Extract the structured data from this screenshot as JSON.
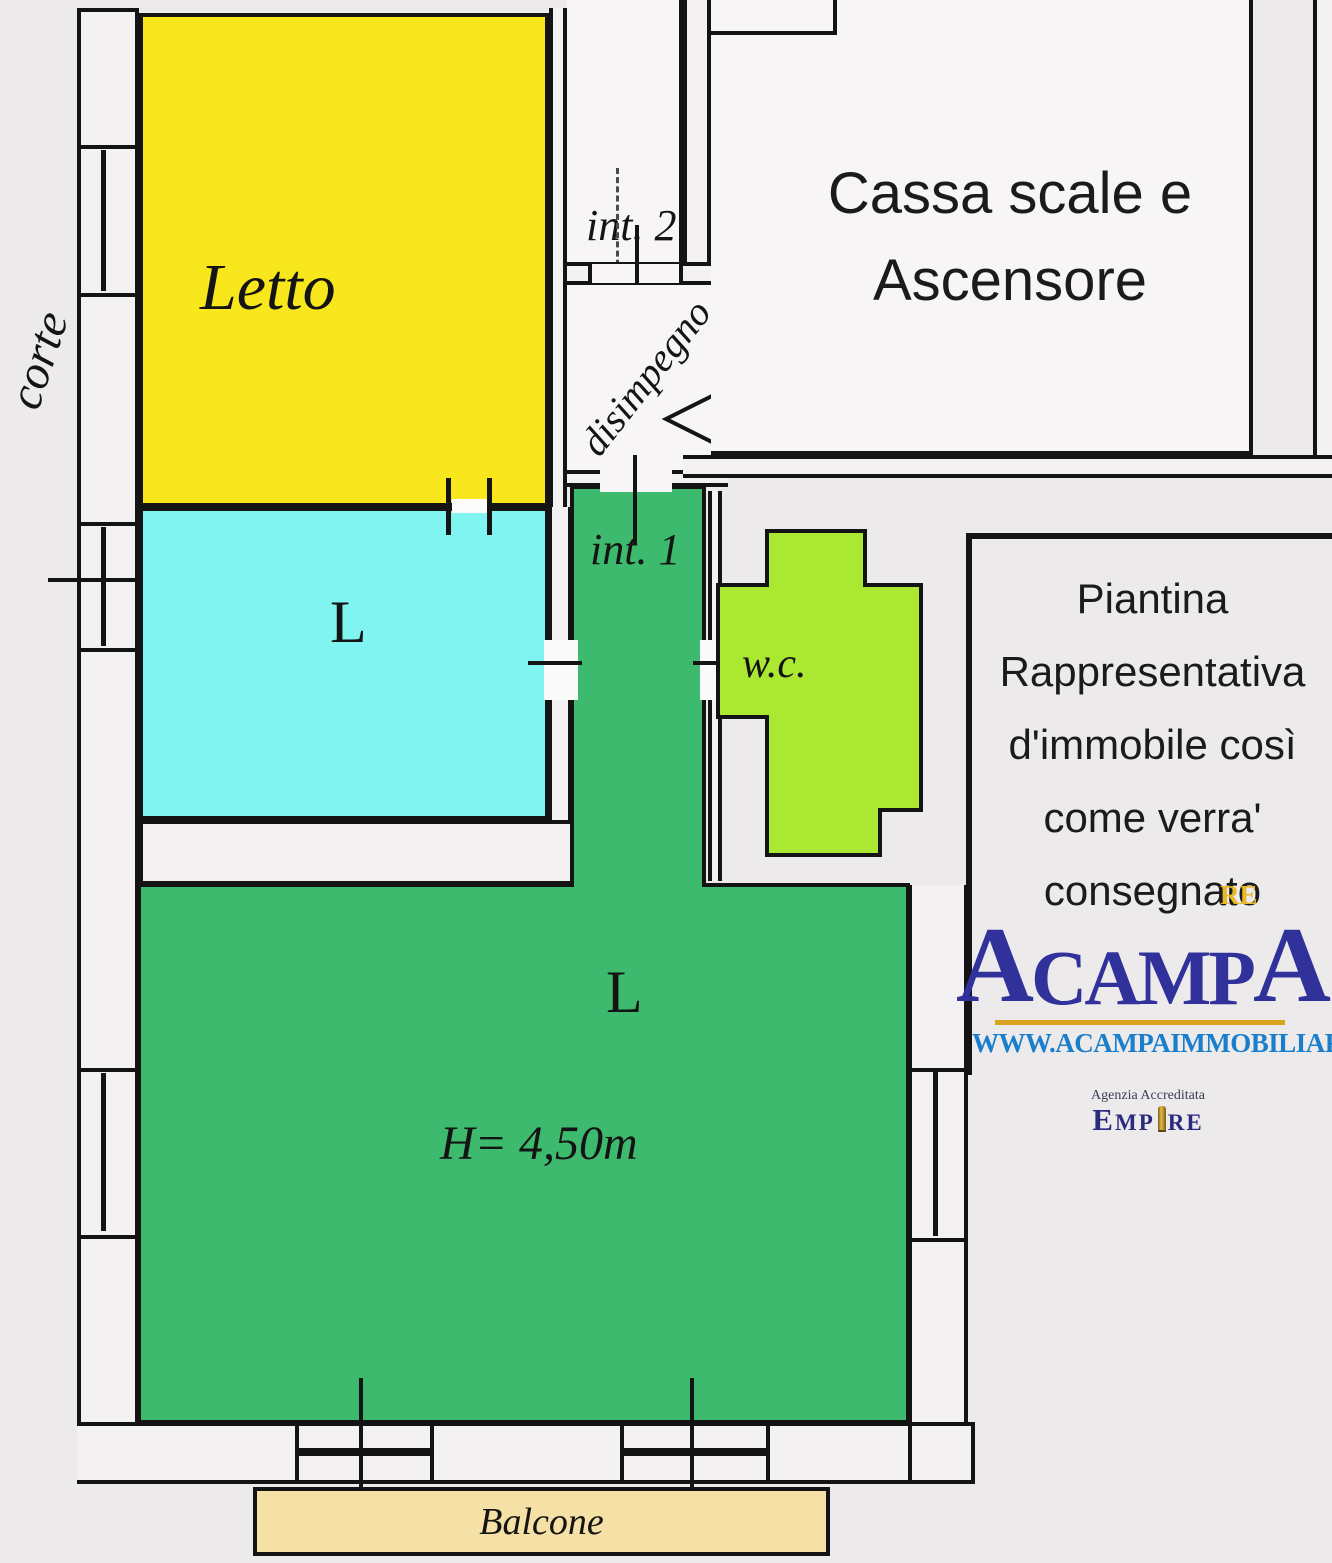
{
  "plan_title": "floor-plan",
  "rooms": {
    "letto": {
      "label": "Letto",
      "color": "#f8e71c"
    },
    "living_small": {
      "label": "L",
      "color": "#80f4f0"
    },
    "corridor": {
      "label": "int. 1",
      "color": "#3eba6e"
    },
    "living_large": {
      "label": "L",
      "height_note": "H= 4,50m",
      "color": "#3eba6e"
    },
    "wc": {
      "label": "w.c.",
      "color": "#abe832"
    },
    "stairwell": {
      "line1": "Cassa scale e",
      "line2": "Ascensore"
    },
    "int2": {
      "label": "int. 2"
    },
    "disimpegno": {
      "label": "disimpegno"
    },
    "balcone": {
      "label": "Balcone",
      "color": "#f5e0a5"
    },
    "corte": {
      "label": "corte"
    }
  },
  "annotation": {
    "lines": [
      "Piantina",
      "Rappresentativa",
      "d'immobile così",
      "come verra'",
      "consegnato"
    ]
  },
  "logo": {
    "brand_first": "A",
    "brand_middle": "CAMP",
    "brand_last": "A",
    "re_tag": "RE",
    "website": "WWW.ACAMPAIMMOBILIARE.IT",
    "accreditation": "Agenzia Accreditata",
    "empire_e": "E",
    "empire_mp": "MP",
    "empire_re": "RE",
    "brand_color": "#31319b",
    "re_color": "#e8b923",
    "website_color": "#1b7ecb",
    "underline_color": "#d9a520",
    "empire_color": "#2b2b7e"
  },
  "colors": {
    "wall_line": "#141414",
    "wall_fill": "#f4f1f3",
    "background": "#edeaec"
  }
}
